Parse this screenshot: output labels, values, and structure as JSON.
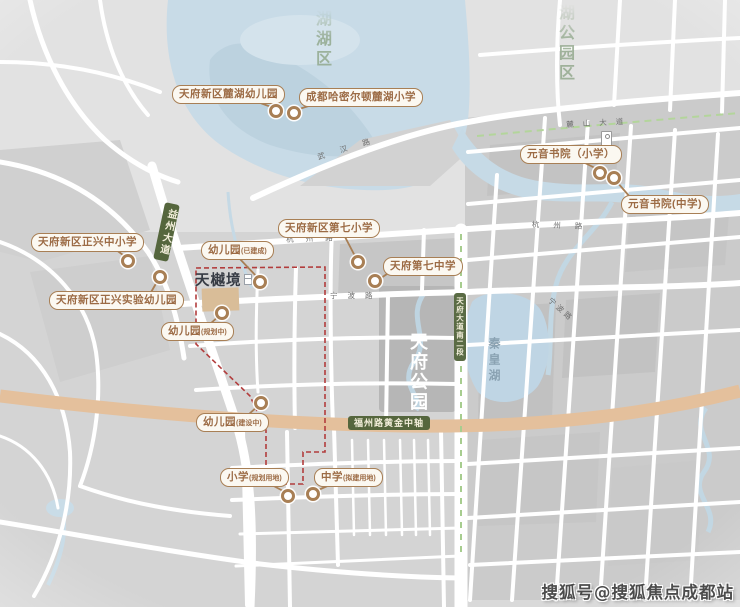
{
  "watermark": {
    "text": "搜狐号@搜狐焦点成都站"
  },
  "project": {
    "name": "天樾境"
  },
  "districts": {
    "north_lake": "湖湖区",
    "northeast_park": "湖公园区"
  },
  "areas": {
    "central_park": "天府公园",
    "qinhuang_lake": "秦皇湖"
  },
  "road_badges": {
    "yizhou_avenue": "益州大道",
    "tianfu_avenue_s2": "天府大道南二段",
    "fuzhou_golden_axis": "福州路黄金中轴"
  },
  "road_names": {
    "wuhan_rd": "武汉路",
    "hangzhou_rd": "杭州路",
    "ningbo_rd": "宁波路",
    "lushan_avenue": "麓山大道"
  },
  "schools": [
    {
      "label": "天府新区麓湖幼儿园",
      "sub": ""
    },
    {
      "label": "成都哈密尔顿麓湖小学",
      "sub": ""
    },
    {
      "label": "天府新区正兴中小学",
      "sub": ""
    },
    {
      "label": "天府新区正兴实验幼儿园",
      "sub": ""
    },
    {
      "label": "幼儿园",
      "sub": "(已建成)"
    },
    {
      "label": "天府新区第七小学",
      "sub": ""
    },
    {
      "label": "天府第七中学",
      "sub": ""
    },
    {
      "label": "幼儿园",
      "sub": "(规划中)"
    },
    {
      "label": "幼儿园",
      "sub": "(建设中)"
    },
    {
      "label": "小学",
      "sub": "(规划用地)"
    },
    {
      "label": "中学",
      "sub": "(拟建用地)"
    },
    {
      "label": "元音书院（小学）",
      "sub": ""
    },
    {
      "label": "元音书院(中学)",
      "sub": ""
    }
  ],
  "colors": {
    "label_brown": "#a87f55",
    "badge_green": "#55663d",
    "boundary_red": "#b23d3d",
    "road_tan": "#e4c09c",
    "water_blue": "#c8dbe7",
    "district_green": "#8fa689"
  }
}
